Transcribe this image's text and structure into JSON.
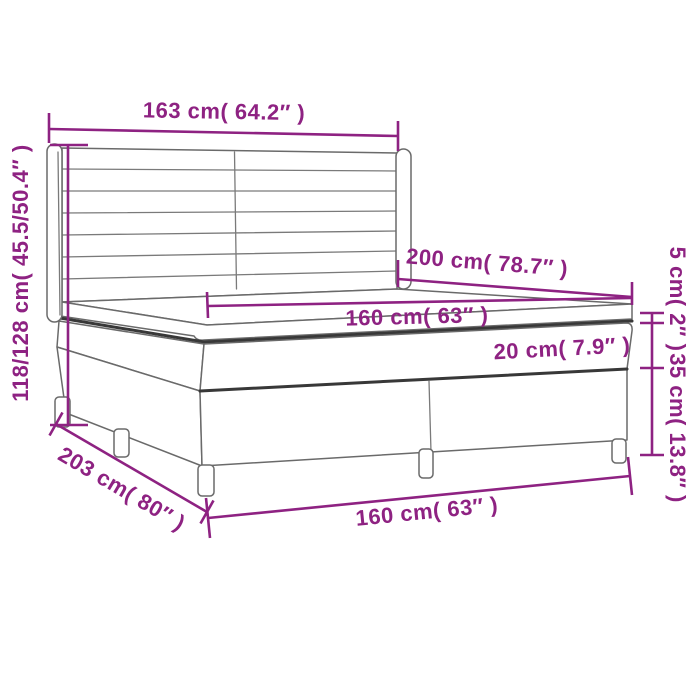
{
  "diagram": {
    "type": "product-dimension-diagram",
    "subject": "box spring bed with winged headboard, mattress and topper",
    "accent_color": "#8e2282",
    "outline_color": "#6a6a6a",
    "background_color": "#ffffff",
    "dimensions": {
      "headboard_width": "163 cm( 64.2″ )",
      "total_height": "118/128 cm( 45.5/50.4″ )",
      "bed_length": "200 cm( 78.7″ )",
      "mattress_width": "160 cm( 63″ )",
      "mattress_height": "20 cm( 7.9″ )",
      "topper_height": "5 cm( 2″ )",
      "box_height": "35 cm( 13.8″ )",
      "base_length": "203 cm( 80″ )",
      "base_width": "160 cm( 63″ )"
    }
  }
}
